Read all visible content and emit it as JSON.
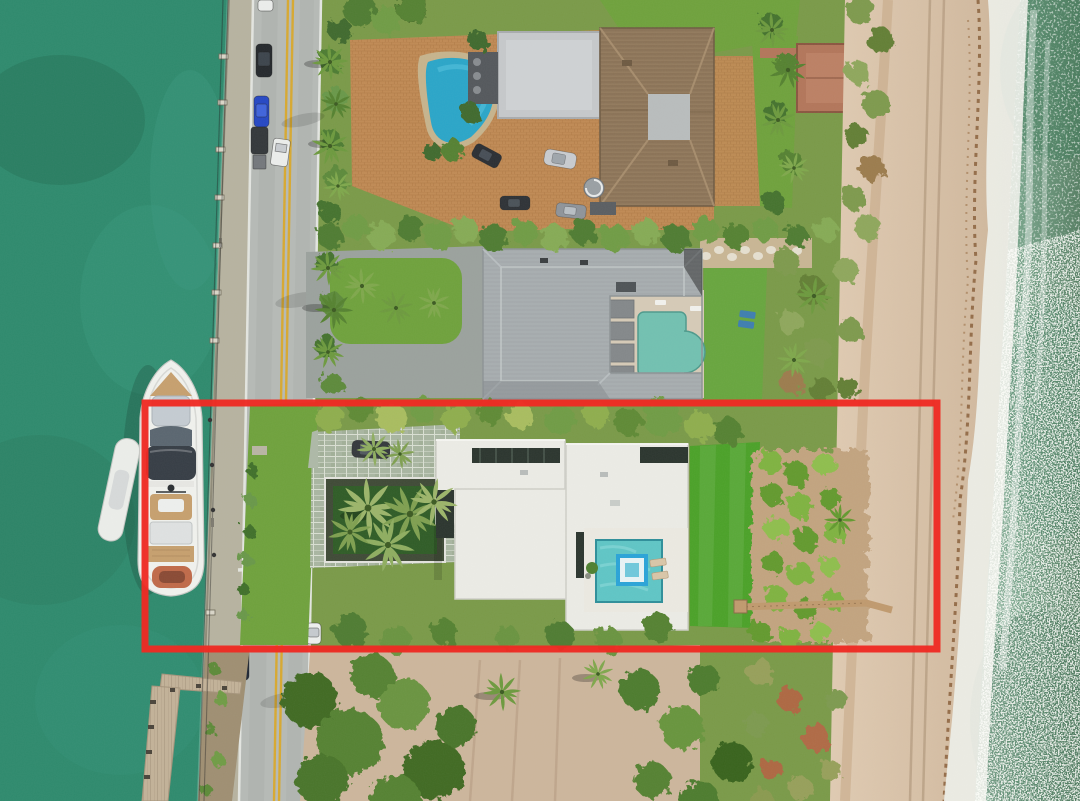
{
  "image": {
    "title": "Aerial drone view of oceanfront estates with a red boundary highlighting the center beachfront property",
    "type": "aerial-drone-photograph",
    "annotation": {
      "shape": "rectangle",
      "color": "#EE2B23",
      "x": 145,
      "y": 403,
      "width": 792,
      "height": 246,
      "stroke_width": 7
    },
    "palette": {
      "intracoastal": "#2E8A6D",
      "intracoastal_dark": "#27745A",
      "ocean": "#7FA893",
      "ocean_deep": "#567F63",
      "surf_foam": "#EEF0E9",
      "beach_sand": "#D6C0A8",
      "wrack_brown": "#8A5F3A",
      "road_asphalt": "#B6BAB6",
      "lane_yellow": "#D8A930",
      "edge_white": "#E9EBE7",
      "lawn": "#6FA23C",
      "lawn_bright": "#4BA228",
      "hedge_dark": "#41702C",
      "palm_green": "#6D9A3E",
      "dune_olive": "#7E9A4E",
      "dune_rust": "#AE6743",
      "paver_terracotta": "#C08A54",
      "paver_green_gray": "#A9B6A1",
      "roof_brown": "#8F775A",
      "roof_gray": "#A8AEB0",
      "roof_white": "#ECECE6",
      "glass_dark": "#2B352E",
      "pool_blue": "#2AA6C9",
      "pool_teal": "#72C1B1",
      "pool_mosaic": "#5FC6C6",
      "spa_blue": "#2AA4D8",
      "deck_cream": "#D6CBB7",
      "dock_wood": "#C3B298",
      "boardwalk_wood": "#B3765A",
      "yacht_hull": "#F1F2EE",
      "yacht_teak": "#C7A06E",
      "yacht_canopy": "#363D45",
      "seawall_concrete": "#B7B3A0"
    },
    "features": [
      "intracoastal waterway",
      "seawall walkway with dock posts",
      "docked motor yacht with tender",
      "two-lane coastal road with double yellow centerline",
      "parked cars",
      "estate with terracotta motor court and freeform pool",
      "estate with gray hip roof and courtyard pool",
      "highlighted modern white flat-roof estate with mosaic pool and spa",
      "private beach boardwalk",
      "dune vegetation",
      "sandy beach with seaweed wrack line",
      "breaking surf",
      "ocean with sun glitter",
      "wooden finger pier",
      "vacant sandy lot with trees"
    ]
  }
}
